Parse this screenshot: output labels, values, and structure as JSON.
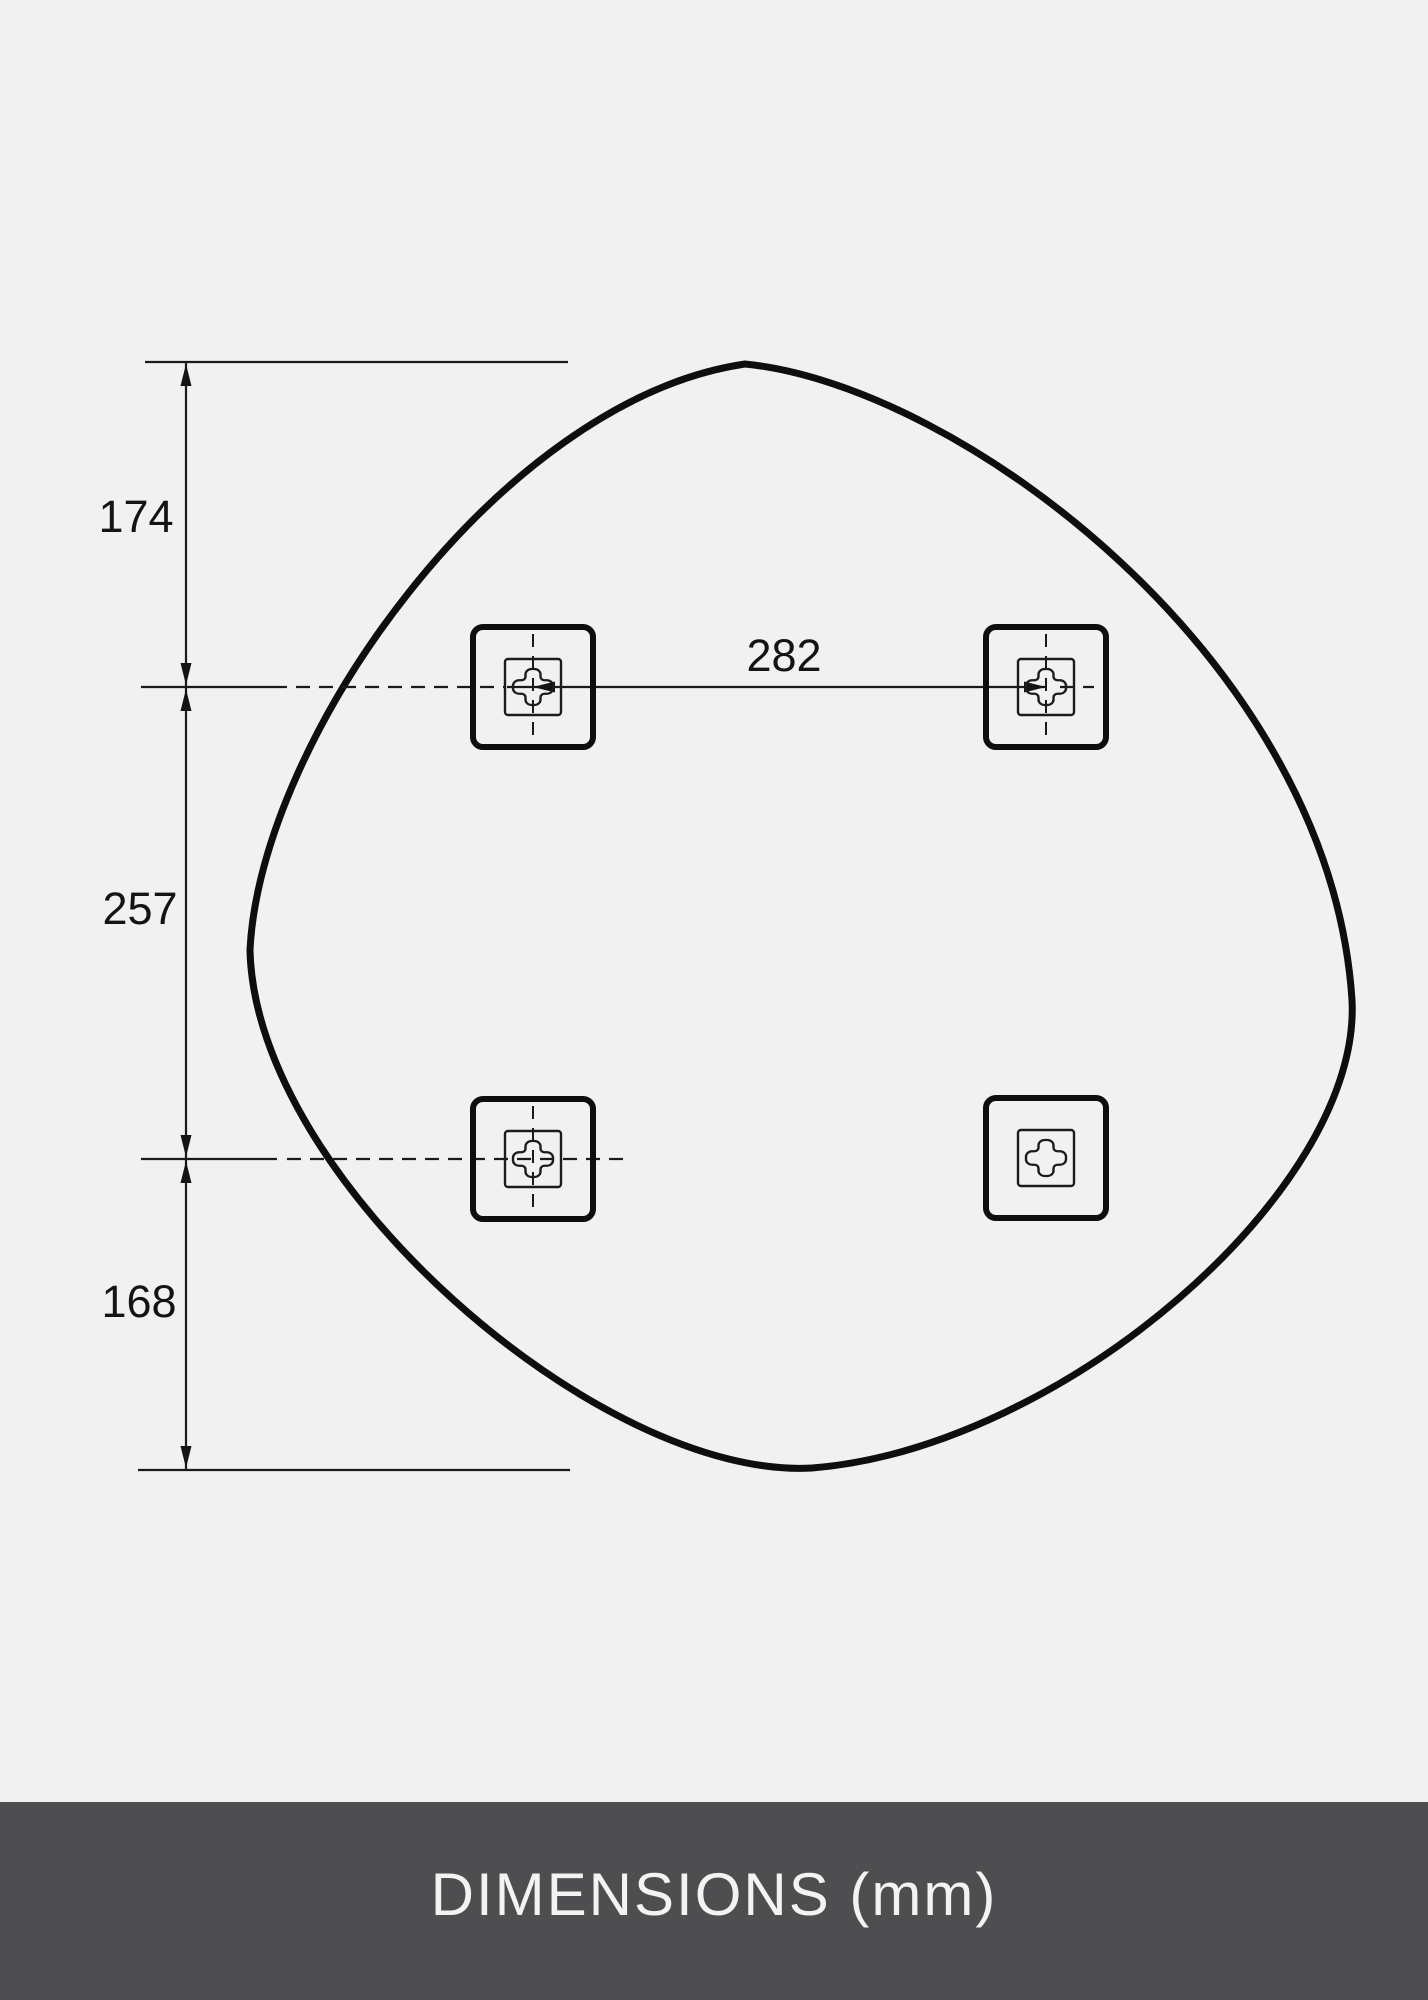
{
  "canvas": {
    "background": "#f1f1f2",
    "outline_color": "#0e0e0e",
    "thin_line_color": "#1a1a1a"
  },
  "dimensions": {
    "unit": "mm",
    "top_to_upper_holes": "174",
    "upper_to_lower_holes": "257",
    "lower_holes_to_bottom": "168",
    "hole_spacing_horizontal": "282"
  },
  "brackets": {
    "count": 4,
    "icon": "cross-keyhole-plate"
  },
  "footer": {
    "label": "DIMENSIONS (mm)",
    "background": "#4e4e50",
    "text_color": "#f4f3f1"
  }
}
